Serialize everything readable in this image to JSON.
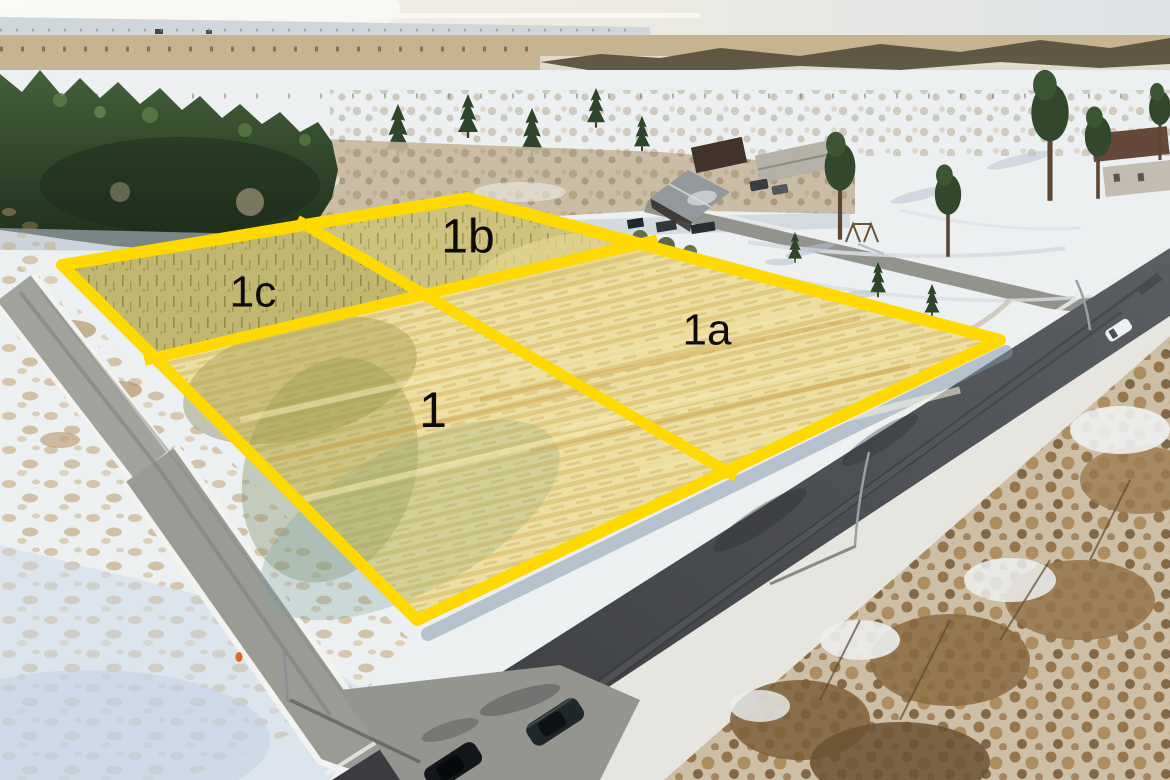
{
  "scene": {
    "description": "Winter aerial drone photograph of four land plots outlined in yellow, beside a dark asphalt road and a smaller gravel road, with houses, conifer forest, snowy fields and parked cars"
  },
  "plots": [
    {
      "id": "plot-1",
      "label": "1"
    },
    {
      "id": "plot-1a",
      "label": "1a"
    },
    {
      "id": "plot-1b",
      "label": "1b"
    },
    {
      "id": "plot-1c",
      "label": "1c"
    }
  ],
  "colors": {
    "plot_boundary": "#FFD900",
    "plot_fill": "rgba(255,214,0,0.20)",
    "plot_label": "#0c0c0c"
  }
}
